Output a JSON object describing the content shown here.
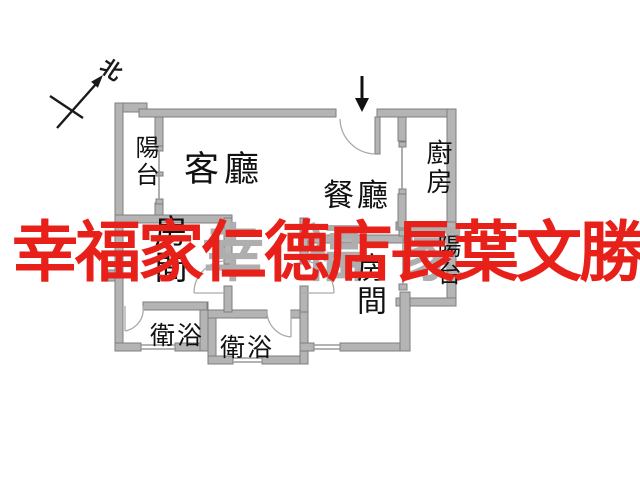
{
  "title": "apartment-floor-plan",
  "compass": {
    "label": "北"
  },
  "rooms": {
    "balcony_left": {
      "label": "陽台"
    },
    "living": {
      "label": "客廳"
    },
    "dining": {
      "label": "餐廳"
    },
    "kitchen": {
      "label": "廚房"
    },
    "bedroom_left": {
      "label": "房間"
    },
    "bedroom_right": {
      "label": "房間"
    },
    "bath_left": {
      "label": "衛浴"
    },
    "bath_right": {
      "label": "衛浴"
    },
    "balcony_right": {
      "label": "陽台"
    }
  },
  "watermark": {
    "red_text": "幸福家仁德店長葉文勝",
    "red_color": "#e8201a",
    "gray_text": "幸福家",
    "gray_color": "#aeaeae"
  },
  "colors": {
    "wall_fill": "#b4b4b4",
    "wall_stroke": "#7e7e7e",
    "thin_line": "#9a9a9a",
    "door_arc": "#aaaaaa",
    "label_color": "#111111",
    "background": "#ffffff"
  }
}
